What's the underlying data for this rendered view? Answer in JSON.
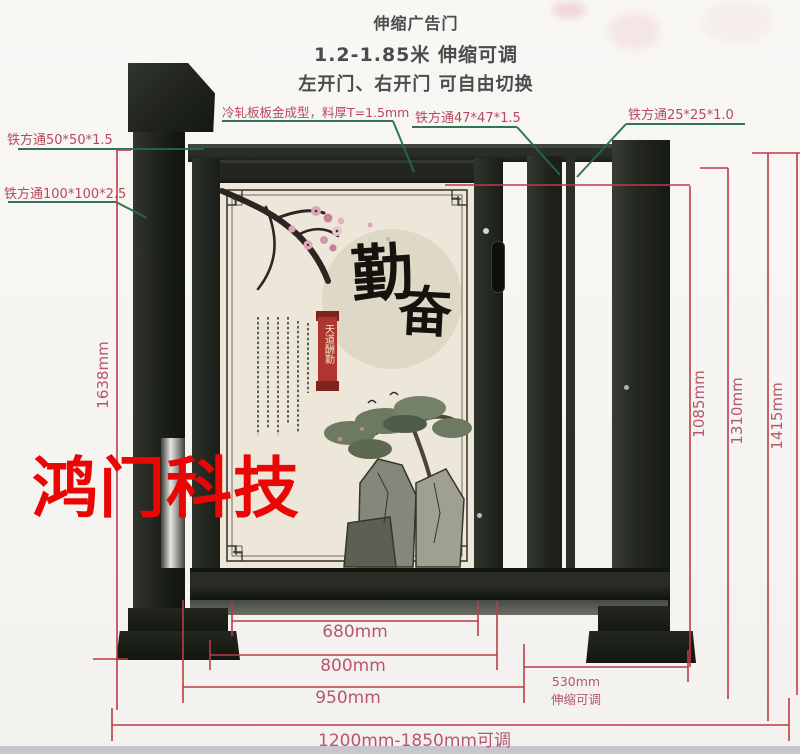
{
  "header": {
    "line1": "伸缩广告门",
    "line2": "1.2-1.85米 伸缩可调",
    "line3": "左开门、右开门 可自由切换"
  },
  "labels": {
    "tube_50": "铁方通50*50*1.5",
    "tube_100": "铁方通100*100*2.5",
    "cold_rolled": "冷轧板板金成型，料厚T=1.5mm",
    "tube_47": "铁方通47*47*1.5",
    "tube_25": "铁方通25*25*1.0"
  },
  "dimensions": {
    "total_height_left": "1638mm",
    "height_inner_right": "1085mm",
    "height_mid_right": "1310mm",
    "height_outer_right": "1415mm",
    "width_panel": "680mm",
    "width_door": "800mm",
    "width_frame": "950mm",
    "telescopic_width": "530mm",
    "telescopic_note": "伸缩可调",
    "overall_width_range": "1200mm-1850mm可调"
  },
  "watermark": "鸿门科技",
  "panel_art": {
    "char_top": "勤",
    "char_bottom": "奋",
    "seal_text": "天道酬勤"
  },
  "colors": {
    "red_line": "#bc3b47",
    "label_pink": "#b8495c",
    "dim_text_pink": "#b8556f",
    "leader_green": "#226a4e",
    "watermark_red": "#eb0606",
    "gate_dark": "#22261f",
    "panel_cream": "#ece7d8",
    "seal_red": "#b0352e"
  }
}
